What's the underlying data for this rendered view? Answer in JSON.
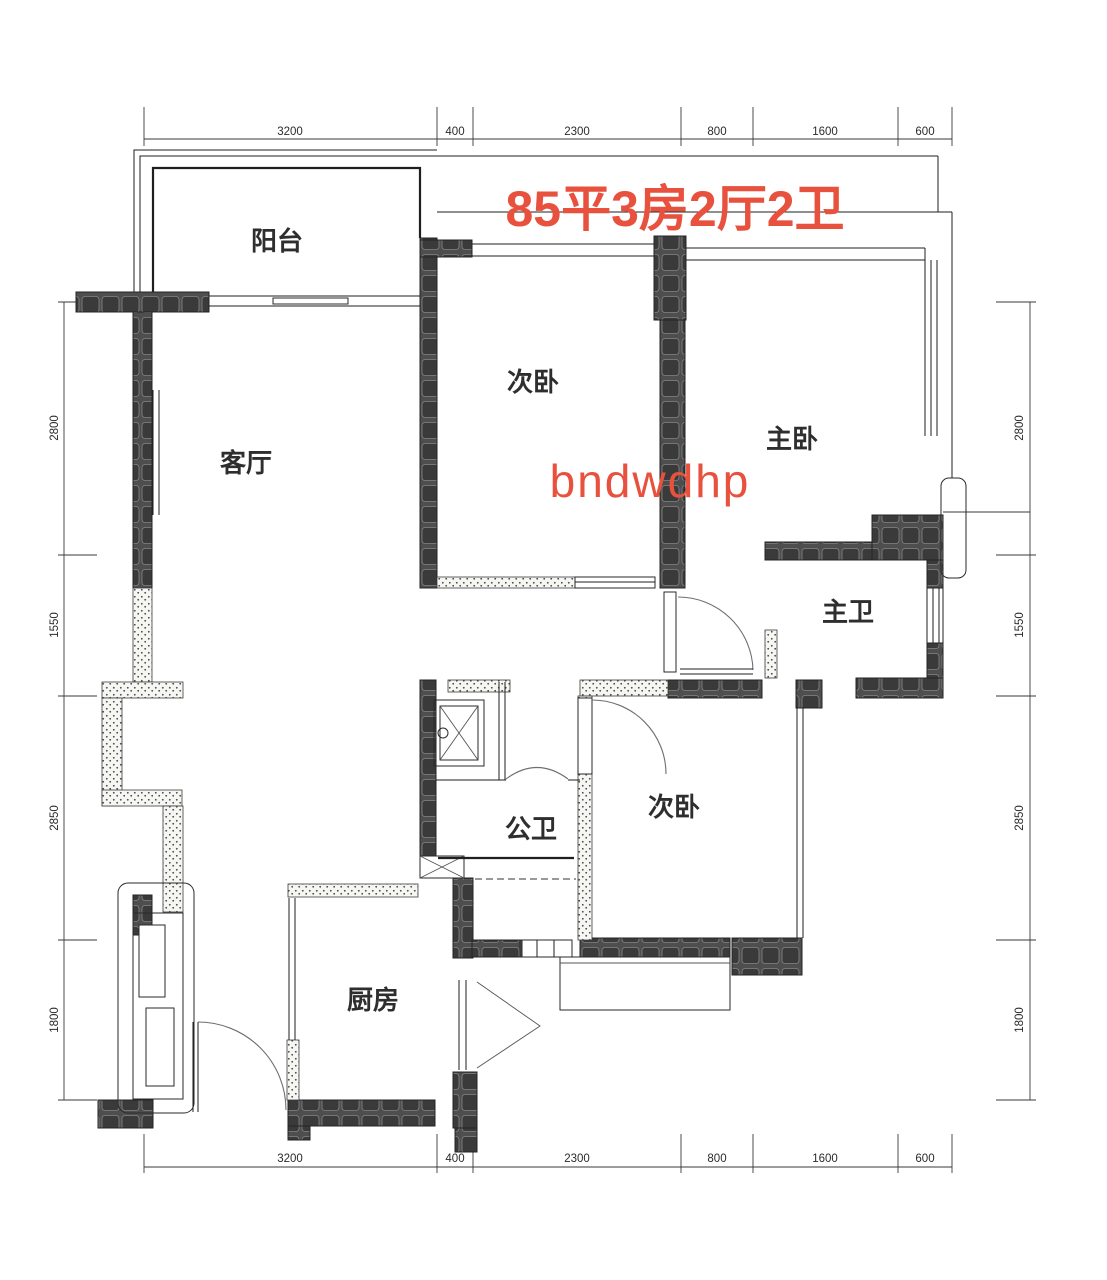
{
  "title": {
    "text": "85平3房2厅2卫",
    "color": "#e8513d"
  },
  "watermark": {
    "text": "bndwdhp",
    "color": "#e8513d"
  },
  "rooms": {
    "balcony": {
      "label": "阳台"
    },
    "living": {
      "label": "客厅"
    },
    "bedroom_top": {
      "label": "次卧"
    },
    "master": {
      "label": "主卧"
    },
    "master_bath": {
      "label": "主卫"
    },
    "public_bath": {
      "label": "公卫"
    },
    "bedroom_low": {
      "label": "次卧"
    },
    "kitchen": {
      "label": "厨房"
    }
  },
  "dimensions": {
    "top": [
      "3200",
      "400",
      "2300",
      "800",
      "1600",
      "600"
    ],
    "bottom": [
      "3200",
      "400",
      "2300",
      "800",
      "1600",
      "600"
    ],
    "left": [
      "2800",
      "1550",
      "2850",
      "1800"
    ],
    "right": [
      "2800",
      "1550",
      "2850",
      "1800"
    ]
  },
  "colors": {
    "accent": "#e8513d",
    "wall_dark": "#4e4e4e",
    "line": "#1f1f1f"
  }
}
